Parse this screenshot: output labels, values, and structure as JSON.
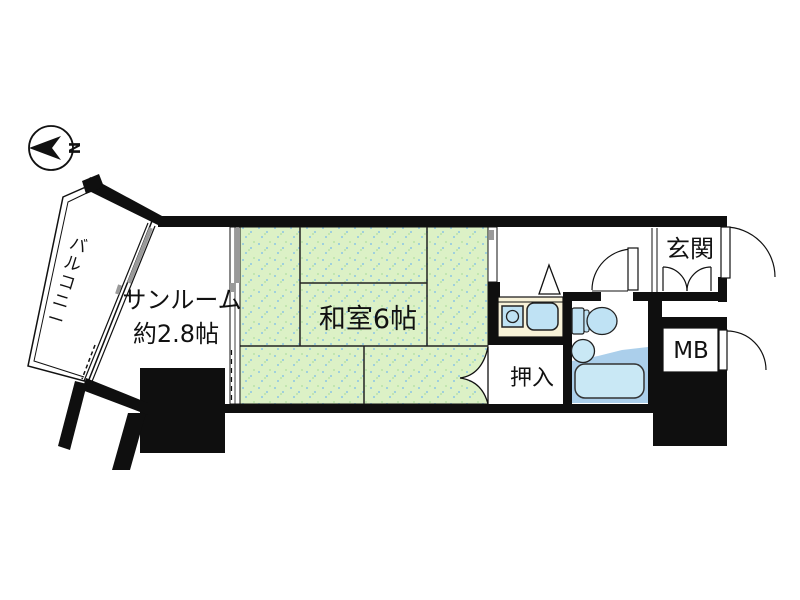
{
  "compass": {
    "north_label": "N"
  },
  "rooms": {
    "balcony": {
      "label": "バルコニー"
    },
    "sunroom": {
      "label_line1": "サンルーム",
      "label_line2": "約2.8帖"
    },
    "japanese_room": {
      "label": "和室6帖"
    },
    "closet": {
      "label": "押入"
    },
    "entrance": {
      "label": "玄関"
    },
    "meter_box": {
      "label": "MB"
    }
  },
  "colors": {
    "wall_black": "#0f0f0f",
    "tatami_green": "#dcf1c6",
    "tatami_dot": "#9fd0dd",
    "fixture_blue": "#bfe2f4",
    "tub_blue": "#c9e8f5",
    "bath_floor": "#abcfeb",
    "counter_cream": "#f8f2d8",
    "track_grey": "#9a9a9a"
  }
}
